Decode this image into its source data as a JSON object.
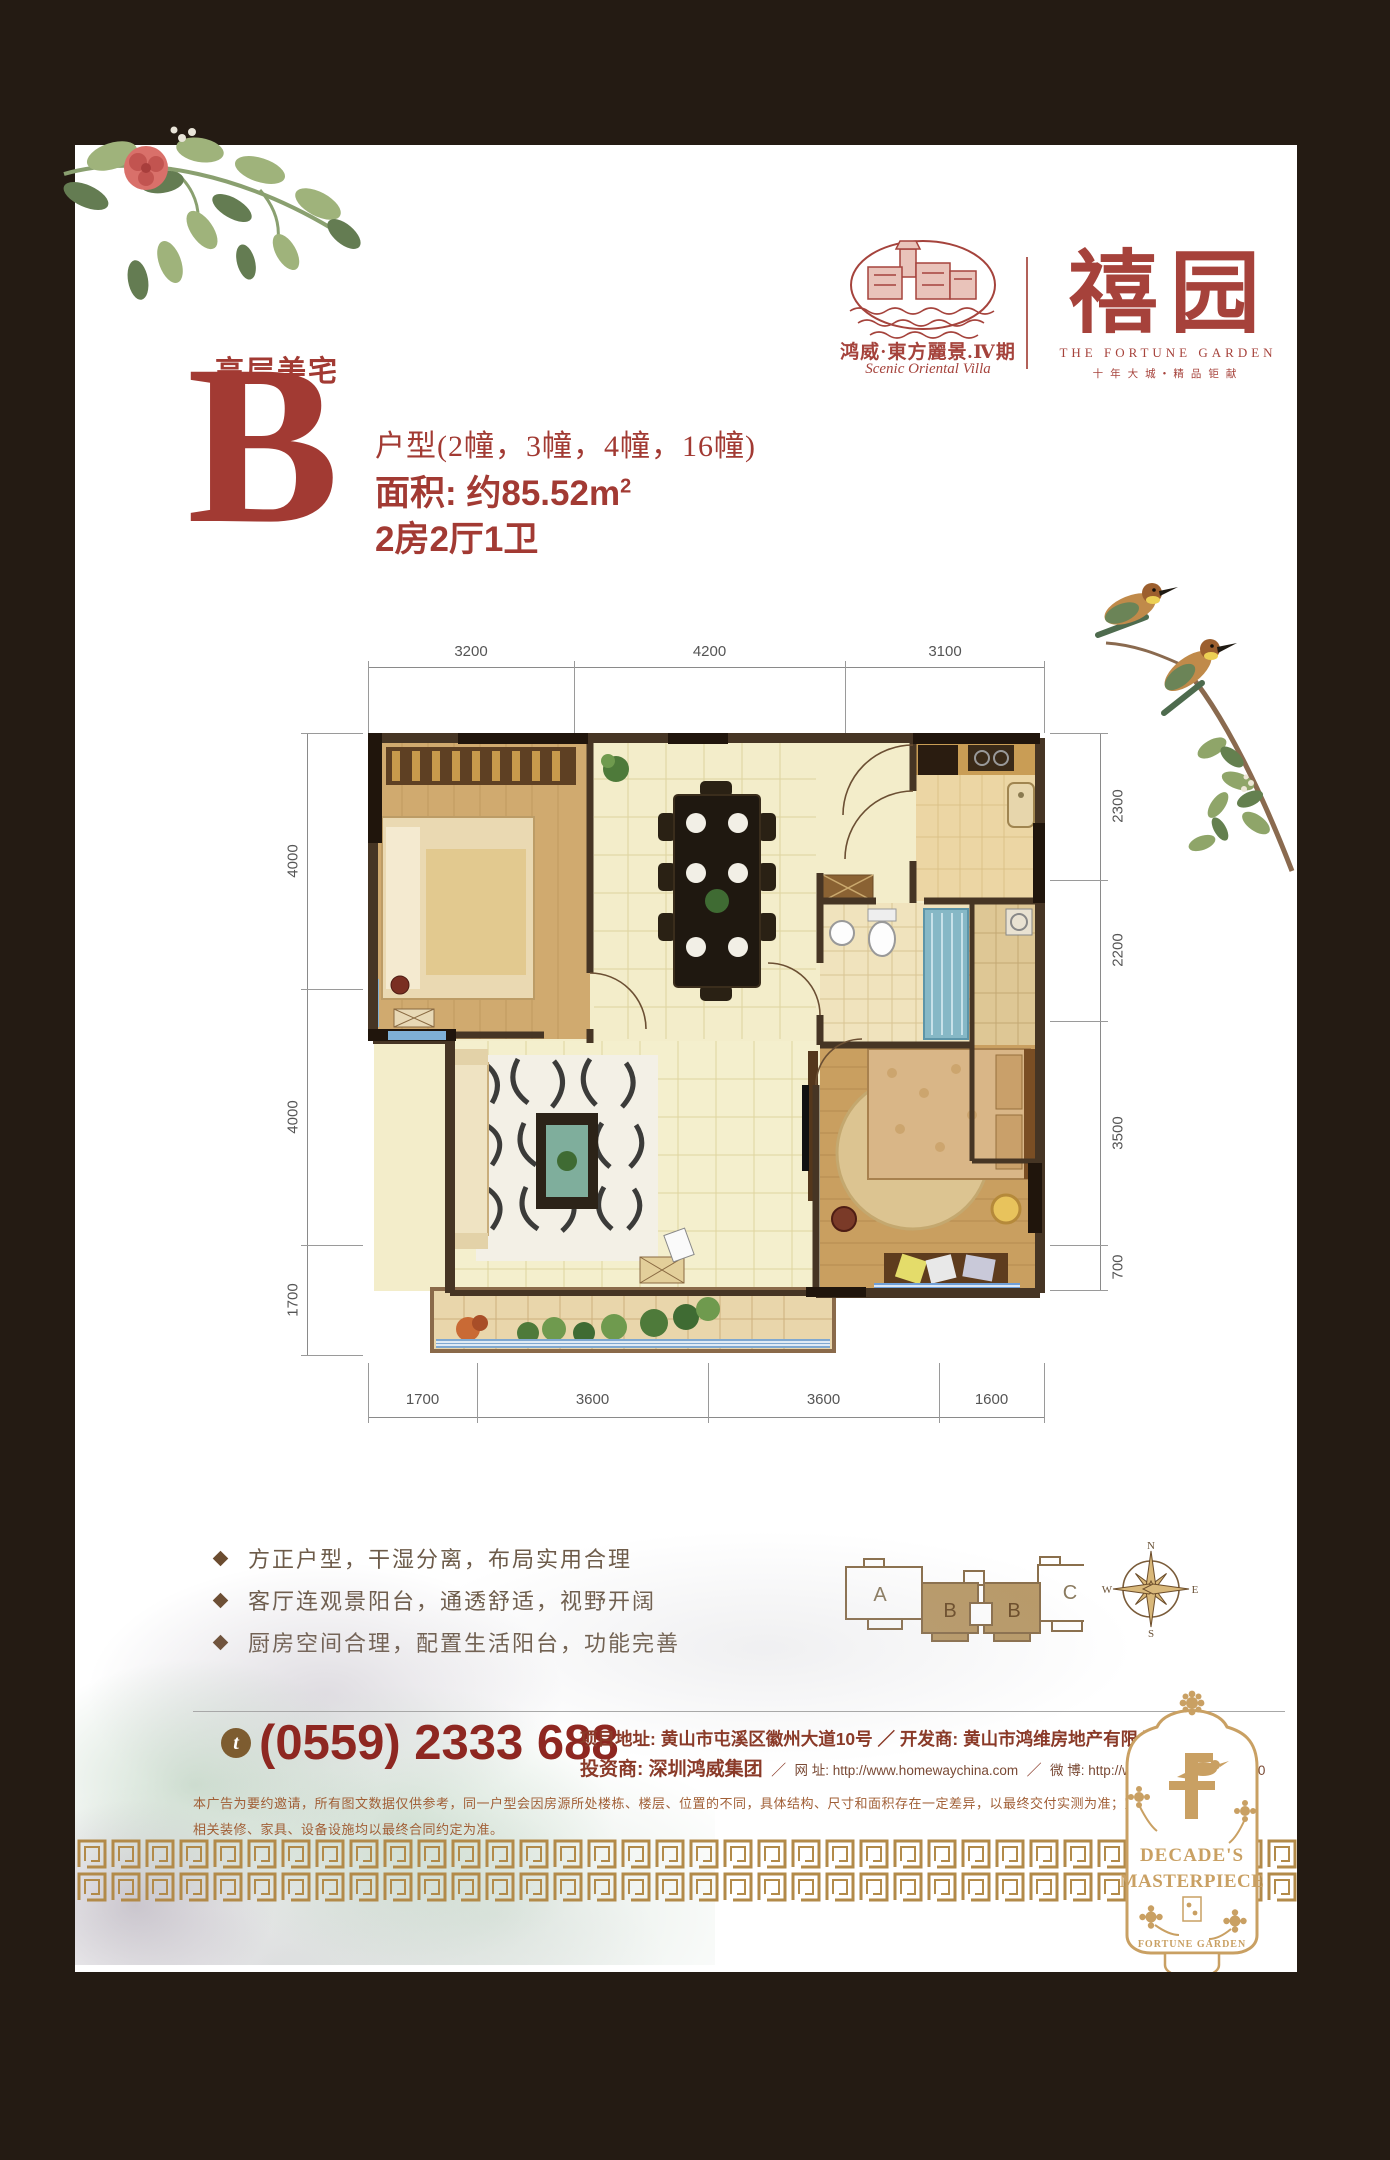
{
  "brand": {
    "estate_logo_cn": "鸿威·東方麗景.Ⅳ期",
    "estate_logo_en": "Scenic Oriental Villa",
    "garden_cn": "禧园",
    "garden_en": "THE FORTUNE GARDEN",
    "garden_tagline": "十年大城•精品钜献"
  },
  "headline": {
    "category": "高层美宅",
    "letter": "B",
    "units": "户型(2幢，3幢，4幢，16幢)",
    "area": "面积: 约85.52m",
    "area_sup": "2",
    "layout": "2房2厅1卫"
  },
  "floorplan": {
    "dims_top": [
      "3200",
      "4200",
      "3100"
    ],
    "dims_left": [
      "4000",
      "4000",
      "1700"
    ],
    "dims_right": [
      "2300",
      "2200",
      "3500",
      "700"
    ],
    "dims_bottom": [
      "1700",
      "3600",
      "3600",
      "1600"
    ]
  },
  "features": [
    "方正户型，干湿分离，布局实用合理",
    "客厅连观景阳台，通透舒适，视野开阔",
    "厨房空间合理，配置生活阳台，功能完善"
  ],
  "keyplan": {
    "unit_a": "A",
    "unit_b1": "B",
    "unit_b2": "B",
    "unit_c": "C"
  },
  "compass": {
    "n": "N",
    "e": "E",
    "s": "S",
    "w": "W"
  },
  "contact": {
    "phone_icon": "t",
    "phone": "(0559) 2333 688",
    "line1": "项目地址: 黄山市屯溪区徽州大道10号 ／ 开发商: 黄山市鸿维房地产有限公司",
    "invest": "投资商: 深圳鸿威集团",
    "sep": "／",
    "web": "网 址: http://www.homewaychina.com",
    "weibo": "微 博: http://weibo.com/2101586350"
  },
  "disclaimer": {
    "line1": "本广告为要约邀请，所有图文数据仅供参考，同一户型会因房源所处楼栋、楼层、位置的不同，具体结构、尺寸和面积存在一定差异，以最终交付实测为准；室内布局均为示意，",
    "line2": "相关装修、家具、设备设施均以最终合同约定为准。"
  },
  "ornament": {
    "word1": "DECADE'S",
    "word2": "MASTERPIECE",
    "word3": "FORTUNE GARDEN"
  },
  "colors": {
    "brand_red": "#a2423a",
    "phone_red": "#8e2721",
    "gold": "#b28a49",
    "tan": "#b99a68"
  }
}
